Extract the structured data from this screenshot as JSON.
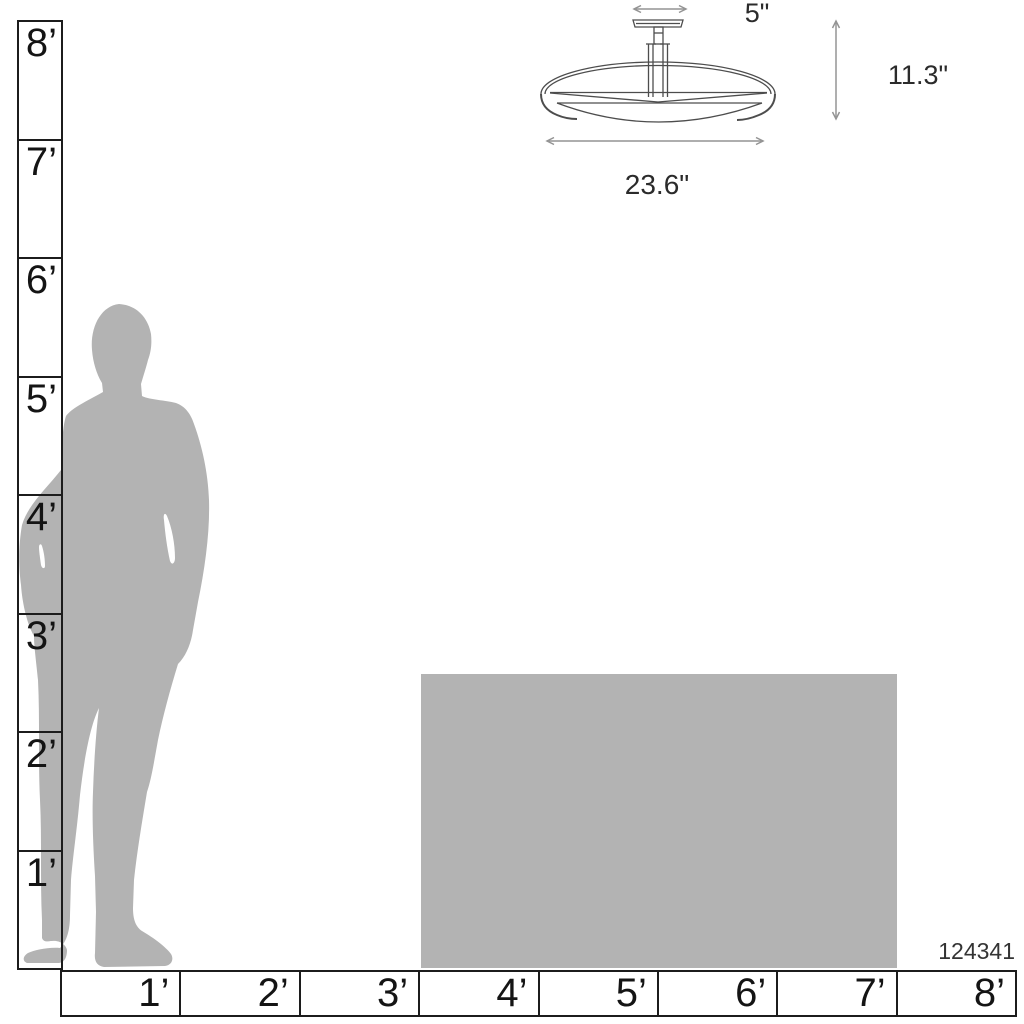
{
  "product": {
    "code": "124341"
  },
  "fixture": {
    "canopy_width_label": "5\"",
    "height_label": "11.3\"",
    "width_label": "23.6\""
  },
  "height_ruler": {
    "unit": "feet",
    "labels": [
      "8’",
      "7’",
      "6’",
      "5’",
      "4’",
      "3’",
      "2’",
      "1’"
    ]
  },
  "width_ruler": {
    "unit": "feet",
    "labels": [
      "1’",
      "2’",
      "3’",
      "4’",
      "5’",
      "6’",
      "7’",
      "8’"
    ]
  },
  "colors": {
    "silhouette_gray": "#b3b3b3",
    "object_gray": "#b3b3b3",
    "ruler_line": "#1c1c1c",
    "drawing_line": "#4d4d4d",
    "arrow_gray": "#949494",
    "label_text": "#2b2b2b"
  }
}
